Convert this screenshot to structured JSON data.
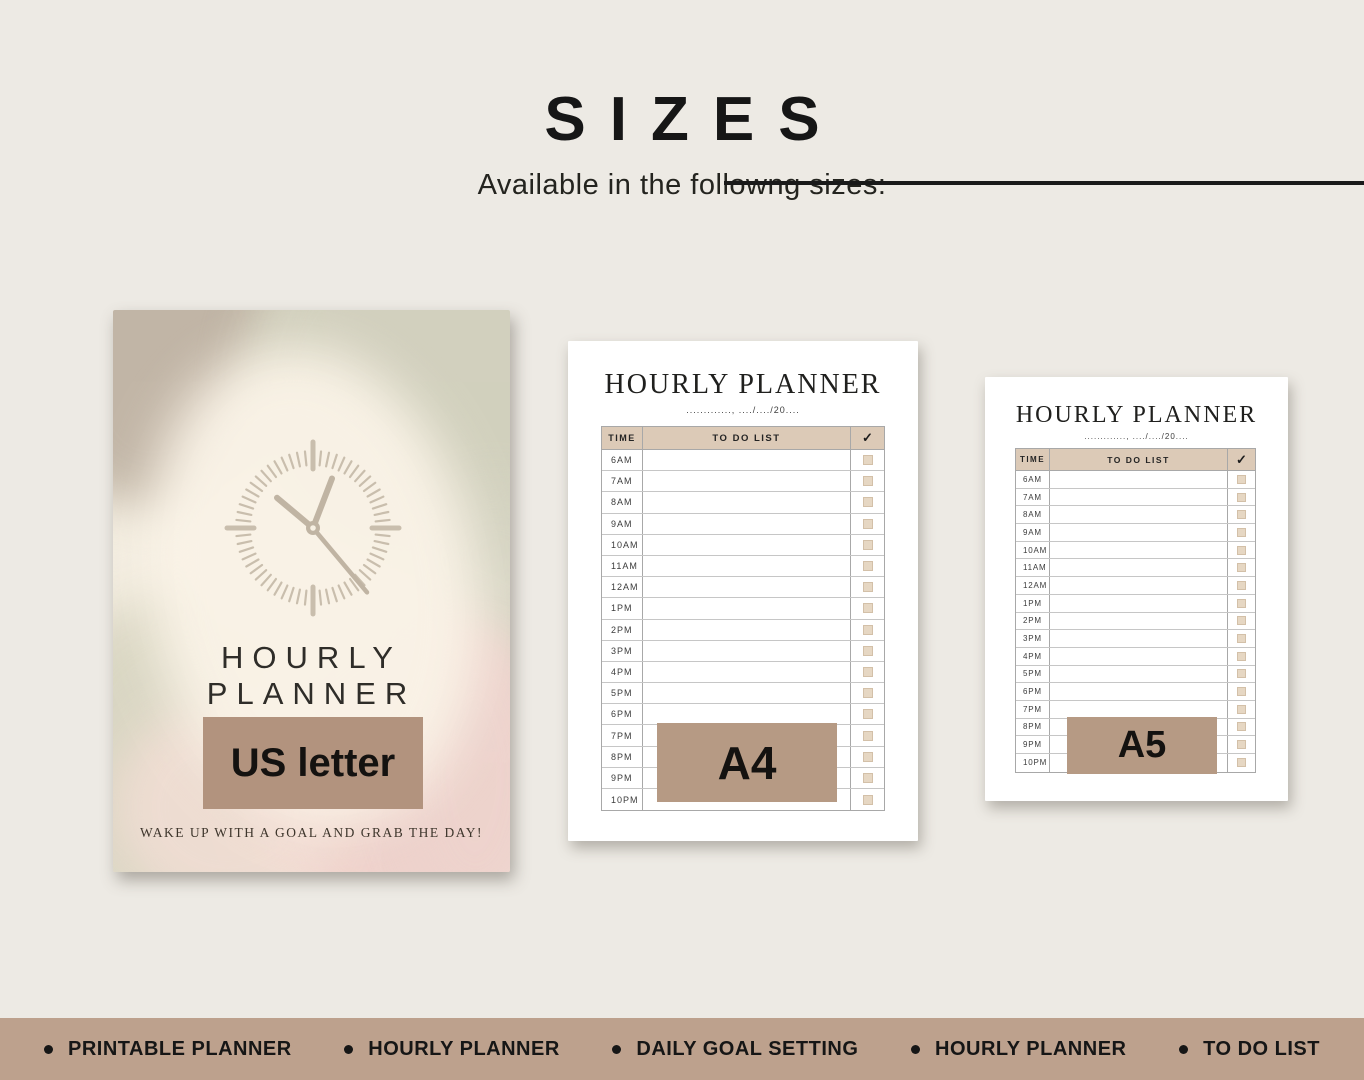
{
  "header": {
    "title": "SIZES",
    "subtitle": "Available in the followng sizes:"
  },
  "us_letter": {
    "title": "HOURLY PLANNER",
    "size_label": "US letter",
    "tagline": "WAKE UP WITH A GOAL AND GRAB THE DAY!"
  },
  "a4": {
    "size_label": "A4"
  },
  "a5": {
    "size_label": "A5"
  },
  "planner": {
    "title": "HOURLY PLANNER",
    "date_line": "............., ..../..../20....",
    "columns": [
      "TIME",
      "TO DO LIST",
      "✓"
    ],
    "times": [
      "6AM",
      "7AM",
      "8AM",
      "9AM",
      "10AM",
      "11AM",
      "12AM",
      "1PM",
      "2PM",
      "3PM",
      "4PM",
      "5PM",
      "6PM",
      "7PM",
      "8PM",
      "9PM",
      "10PM"
    ]
  },
  "footer": {
    "items": [
      "PRINTABLE PLANNER",
      "HOURLY PLANNER",
      "DAILY GOAL SETTING",
      "HOURLY PLANNER",
      "TO DO LIST"
    ]
  },
  "colors": {
    "page_bg": "#edeae4",
    "rule": "#1a1a1a",
    "footer_bar": "#bda18d",
    "badge_us": "#b2937e",
    "badge_a": "#b69a84",
    "table_header": "#dccab7",
    "checkbox": "#e6d7c3",
    "clock_tick": "#c9bead",
    "clock_hand": "#c0b4a3"
  }
}
